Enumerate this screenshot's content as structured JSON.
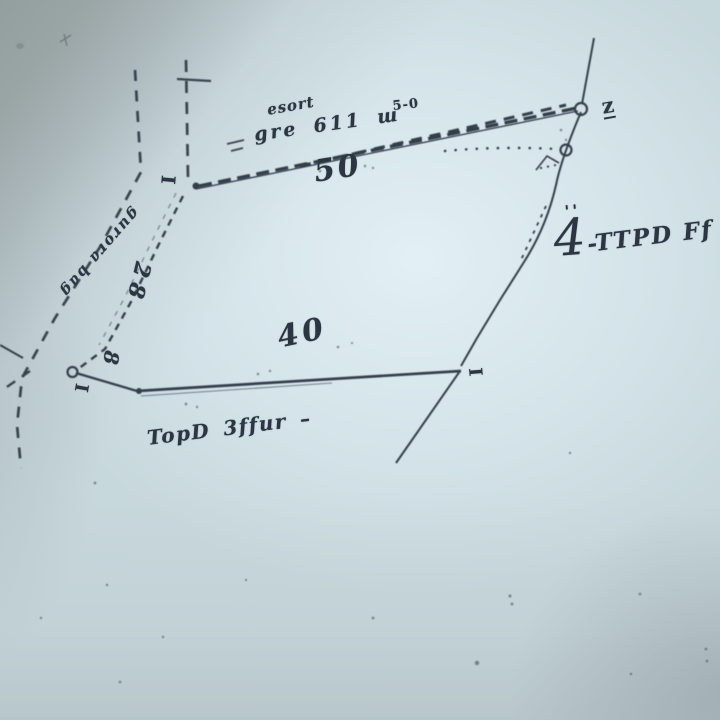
{
  "photo": {
    "paper_tint": "#cfe0e6",
    "corner_shadow_tint": "#99a3a4",
    "ink_color": "#333e4a"
  },
  "sketch": {
    "dimensions": {
      "top_side": "50",
      "bottom_side": "40",
      "left_side": "28",
      "left_side_small": "8"
    },
    "corner_marks": {
      "nw": "I",
      "ne": "z",
      "se": "I",
      "sw": "I"
    },
    "annotations": {
      "top_small_note": "esort",
      "top_pair_note": "5-0",
      "top_plot_note": "gre 611 ш",
      "right_tick_marks": "''",
      "right_numeral": "4",
      "right_text": "-TTPD Ff",
      "bottom_text": "TopD 3ffur –",
      "road_name": "gurora bag"
    }
  }
}
